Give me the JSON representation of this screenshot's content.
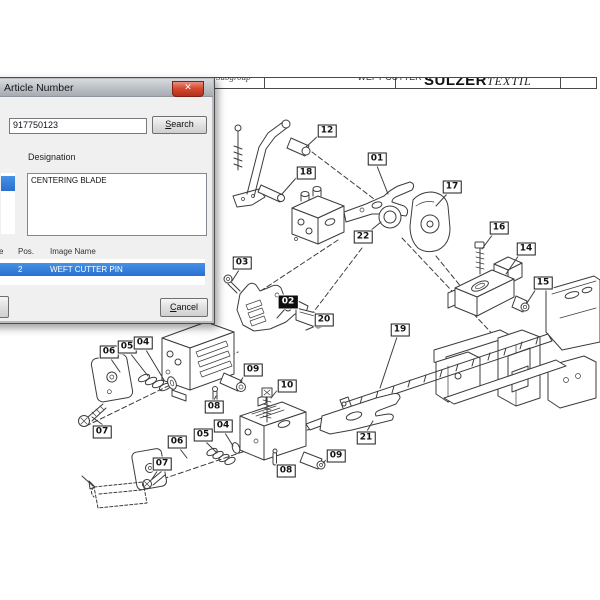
{
  "header": {
    "left_label": "Subgroup",
    "center_label": "WEFT CUTTER W",
    "brand": "SULZER",
    "brand_suffix": "TEXTIL"
  },
  "dialog": {
    "title": "Article Number",
    "close_glyph": "✕",
    "search_value": "917750123",
    "search_button": {
      "key": "S",
      "rest": "earch"
    },
    "designation_label": "Designation",
    "designation_items": [
      "CENTERING BLADE"
    ],
    "results": {
      "name_col_tail": "e",
      "pos_col": "Pos.",
      "image_col": "Image Name",
      "row": {
        "pos": "2",
        "name": "WEFT CUTTER PIN"
      }
    },
    "cancel_button": {
      "key": "C",
      "rest": "ancel"
    },
    "colors": {
      "selection_blue": "#2d7dd8",
      "close_red": "#c53a24"
    }
  },
  "diagram": {
    "highlight_color": "#0d0d0d",
    "labels": [
      {
        "id": "12",
        "x": 327,
        "y": 131
      },
      {
        "id": "18",
        "x": 306,
        "y": 173
      },
      {
        "id": "01",
        "x": 377,
        "y": 159
      },
      {
        "id": "17",
        "x": 452,
        "y": 187
      },
      {
        "id": "22",
        "x": 363,
        "y": 237
      },
      {
        "id": "16",
        "x": 499,
        "y": 228
      },
      {
        "id": "14",
        "x": 526,
        "y": 249
      },
      {
        "id": "15",
        "x": 543,
        "y": 283
      },
      {
        "id": "03",
        "x": 242,
        "y": 263
      },
      {
        "id": "02",
        "x": 288,
        "y": 302,
        "hl": true
      },
      {
        "id": "20",
        "x": 324,
        "y": 320
      },
      {
        "id": "19",
        "x": 400,
        "y": 330
      },
      {
        "id": "06",
        "x": 109,
        "y": 352
      },
      {
        "id": "05",
        "x": 127,
        "y": 347
      },
      {
        "id": "04",
        "x": 143,
        "y": 343
      },
      {
        "id": "09",
        "x": 253,
        "y": 370
      },
      {
        "id": "08",
        "x": 214,
        "y": 407
      },
      {
        "id": "07",
        "x": 102,
        "y": 432
      },
      {
        "id": "10",
        "x": 287,
        "y": 386
      },
      {
        "id": "04",
        "x": 223,
        "y": 426
      },
      {
        "id": "05",
        "x": 203,
        "y": 435
      },
      {
        "id": "06",
        "x": 177,
        "y": 442
      },
      {
        "id": "07",
        "x": 162,
        "y": 464
      },
      {
        "id": "08",
        "x": 286,
        "y": 471
      },
      {
        "id": "09",
        "x": 336,
        "y": 456
      },
      {
        "id": "21",
        "x": 366,
        "y": 438
      }
    ]
  }
}
